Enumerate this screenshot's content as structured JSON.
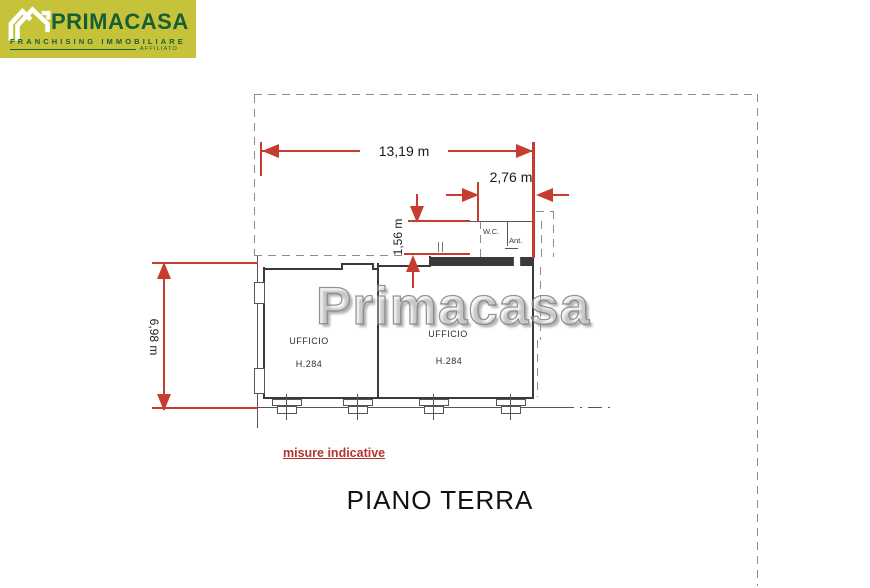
{
  "logo": {
    "brand": "PRIMACASA",
    "tagline": "FRANCHISING IMMOBILIARE",
    "affiliate": "AFFILIATO",
    "bg_color": "#c6c33a",
    "text_color": "#175d36"
  },
  "watermark": "Primacasa",
  "plan": {
    "title": "PIANO TERRA",
    "disclaimer": "misure indicative",
    "dimensions": {
      "total_width": "13,19 m",
      "wc_width": "2,76 m",
      "corridor_height": "1,56 m",
      "left_height": "6,98 m"
    },
    "rooms": {
      "office_left": {
        "name": "UFFICIO",
        "height": "H.284"
      },
      "office_right": {
        "name": "UFFICIO",
        "height": "H.284"
      },
      "wc": {
        "name": "W.C."
      },
      "ante": {
        "name": "Ant."
      }
    },
    "colors": {
      "dimension_red": "#c63d2f"
    }
  }
}
